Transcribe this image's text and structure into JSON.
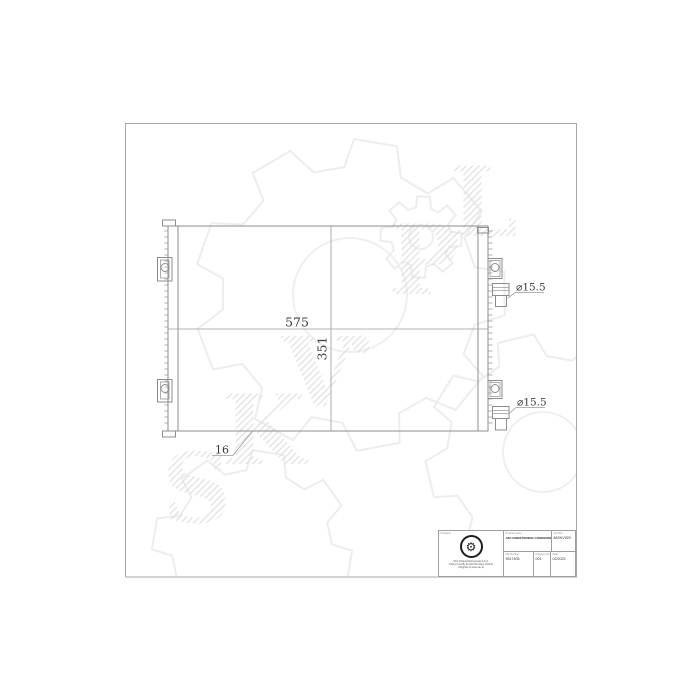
{
  "watermark": {
    "text": "SKV.PL",
    "letters": [
      "S",
      "K",
      "V",
      ".",
      "P",
      "L"
    ],
    "hatch_color": "#e0e0e0",
    "gear_outline_color": "#ededed"
  },
  "drawing": {
    "part": "air-conditioning-condenser-outline",
    "width_dim": "575",
    "height_dim": "351",
    "depth_dim": "16",
    "port_top_diameter": "⌀15.5",
    "port_bottom_diameter": "⌀15.5",
    "line_color": "#8c8c8c",
    "dim_text_color": "#3a3a3a"
  },
  "title_block": {
    "producer_label": "Producer",
    "logo_glyph": "⚙",
    "address_lines": [
      "SKV Poland Motoryzacja S.K.A.",
      "Fabryczna 6B, 61-810 Wrocław, Poland",
      "info@skv.pl  www.skv.pl"
    ],
    "product_name_label": "Product name",
    "product_name": "AIR CONDITIONING CONDENSER",
    "symbol_label": "Symbol",
    "symbol": "86SKV929",
    "oe_number_label": "OE Number",
    "oe_number": "9517405",
    "diagram_no_label": "Diagram No.",
    "diagram_no": "001",
    "date_label": "Date",
    "date": "02/2023"
  }
}
